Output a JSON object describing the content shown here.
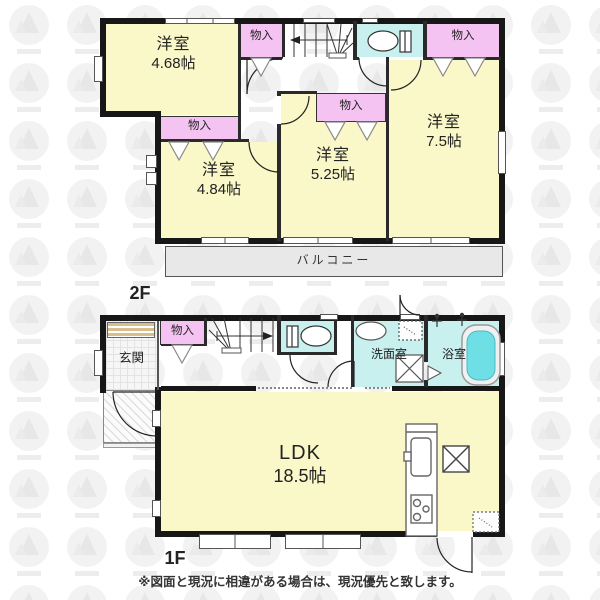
{
  "labels": {
    "floor2": "2F",
    "floor1": "1F",
    "closet": "物入",
    "balcony": "バルコニー",
    "entrance": "玄関",
    "washroom": "洗面室",
    "bathroom": "浴室"
  },
  "rooms": {
    "west2f": {
      "name": "洋室",
      "size": "4.68帖"
    },
    "southwest2f": {
      "name": "洋室",
      "size": "4.84帖"
    },
    "south2f": {
      "name": "洋室",
      "size": "5.25帖"
    },
    "east2f": {
      "name": "洋室",
      "size": "7.5帖"
    },
    "ldk": {
      "name": "LDK",
      "size": "18.5帖"
    }
  },
  "disclaimer": "※図面と現況に相違がある場合は、現況優先と致します。",
  "colors": {
    "room_yellow": "#faf8c8",
    "closet_pink": "#f5c3f2",
    "wet_cyan": "#c8f0ef",
    "tub_water": "#6fdfe6",
    "balcony_gray": "#e8e8e8",
    "wall_black": "#171717",
    "shoe_tan": "#d9be8c",
    "text_dark": "#222222"
  }
}
